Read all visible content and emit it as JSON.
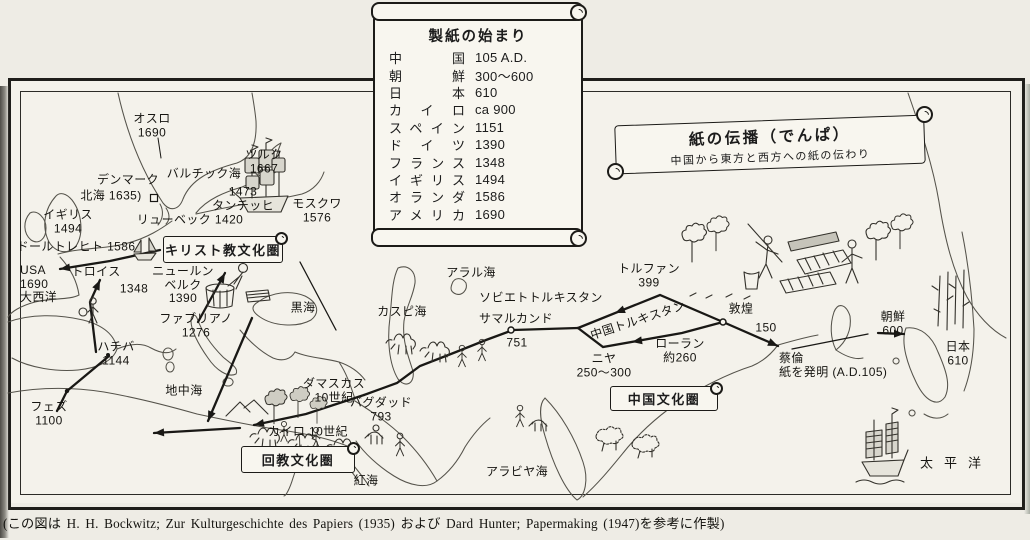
{
  "page": {
    "caption": "(この図は H. H. Bockwitz; Zur Kulturgeschichte des Papiers (1935) および Dard Hunter; Papermaking (1947)を参考に作製)"
  },
  "start_table": {
    "title": "製紙の始まり",
    "rows": [
      {
        "place": "中国",
        "date": "105 A.D."
      },
      {
        "place": "朝鮮",
        "date": "300～600"
      },
      {
        "place": "日本",
        "date": "610"
      },
      {
        "place": "カイロ",
        "date": "ca 900"
      },
      {
        "place": "スペイン",
        "date": "1151"
      },
      {
        "place": "ドイツ",
        "date": "1390"
      },
      {
        "place": "フランス",
        "date": "1348"
      },
      {
        "place": "イギリス",
        "date": "1494"
      },
      {
        "place": "オランダ",
        "date": "1586"
      },
      {
        "place": "アメリカ",
        "date": "1690"
      }
    ]
  },
  "title_banner": {
    "title": "紙の伝播（でんぱ）",
    "subtitle": "中国から東方と西方への紙の伝わり"
  },
  "culture_banners": [
    {
      "label": "キリスト教文化圏",
      "x": 222,
      "y": 248,
      "w": 118,
      "h": 25
    },
    {
      "label": "回教文化圏",
      "x": 297,
      "y": 458,
      "w": 112,
      "h": 25
    },
    {
      "label": "中国文化圏",
      "x": 663,
      "y": 397,
      "w": 106,
      "h": 23
    }
  ],
  "map_labels": [
    {
      "text": "オスロ\n1690",
      "x": 152,
      "y": 126
    },
    {
      "text": "ツルク\n1667",
      "x": 264,
      "y": 162
    },
    {
      "text": "バルチック海",
      "x": 204,
      "y": 174
    },
    {
      "text": "デンマーク",
      "x": 128,
      "y": 180
    },
    {
      "text": "北海 1635)",
      "x": 111,
      "y": 196
    },
    {
      "text": "1473\nタンチッヒ",
      "x": 243,
      "y": 199
    },
    {
      "text": "モスクワ\n1576",
      "x": 317,
      "y": 211
    },
    {
      "text": "リューベック 1420",
      "x": 190,
      "y": 220
    },
    {
      "text": "イギリス\n1494",
      "x": 68,
      "y": 222
    },
    {
      "text": "ドールトレヒト 1586",
      "x": 76,
      "y": 247
    },
    {
      "text": "USA\n1690\n大西洋",
      "x": 20,
      "y": 264,
      "align": "left"
    },
    {
      "text": "トロイス",
      "x": 96,
      "y": 272
    },
    {
      "text": "1348",
      "x": 134,
      "y": 289
    },
    {
      "text": "ニュールン\nベルク\n1390",
      "x": 183,
      "y": 285
    },
    {
      "text": "ファブリアノ\n1276",
      "x": 196,
      "y": 326
    },
    {
      "text": "ハチバ\n1144",
      "x": 116,
      "y": 354
    },
    {
      "text": "フェズ\n1100",
      "x": 49,
      "y": 414
    },
    {
      "text": "地中海",
      "x": 184,
      "y": 391
    },
    {
      "text": "ダマスカス\n10世紀",
      "x": 334,
      "y": 391
    },
    {
      "text": "カイロ 10世紀",
      "x": 308,
      "y": 432
    },
    {
      "text": "バグダッド\n793",
      "x": 381,
      "y": 410
    },
    {
      "text": "紅海",
      "x": 366,
      "y": 481
    },
    {
      "text": "黒海",
      "x": 303,
      "y": 308
    },
    {
      "text": "カスピ海",
      "x": 402,
      "y": 312
    },
    {
      "text": "アラル海",
      "x": 471,
      "y": 273
    },
    {
      "text": "ソビエトトルキスタン",
      "x": 541,
      "y": 298
    },
    {
      "text": "サマルカンド",
      "x": 516,
      "y": 319
    },
    {
      "text": "751",
      "x": 517,
      "y": 343
    },
    {
      "text": "中国トルキスタン",
      "x": 638,
      "y": 321,
      "rotate": -18
    },
    {
      "text": "ニヤ\n250～300",
      "x": 604,
      "y": 366
    },
    {
      "text": "ローラン\n約260",
      "x": 680,
      "y": 351
    },
    {
      "text": "トルファン\n399",
      "x": 649,
      "y": 276
    },
    {
      "text": "敦煌",
      "x": 741,
      "y": 309
    },
    {
      "text": "150",
      "x": 766,
      "y": 328
    },
    {
      "text": "蔡倫\n紙を発明 (A.D.105)",
      "x": 779,
      "y": 352,
      "align": "left"
    },
    {
      "text": "朝鮮\n600",
      "x": 893,
      "y": 324
    },
    {
      "text": "日本\n610",
      "x": 958,
      "y": 354
    },
    {
      "text": "アラビヤ海",
      "x": 517,
      "y": 472
    },
    {
      "text": "太平洋",
      "x": 956,
      "y": 463,
      "spaced": true
    }
  ]
}
